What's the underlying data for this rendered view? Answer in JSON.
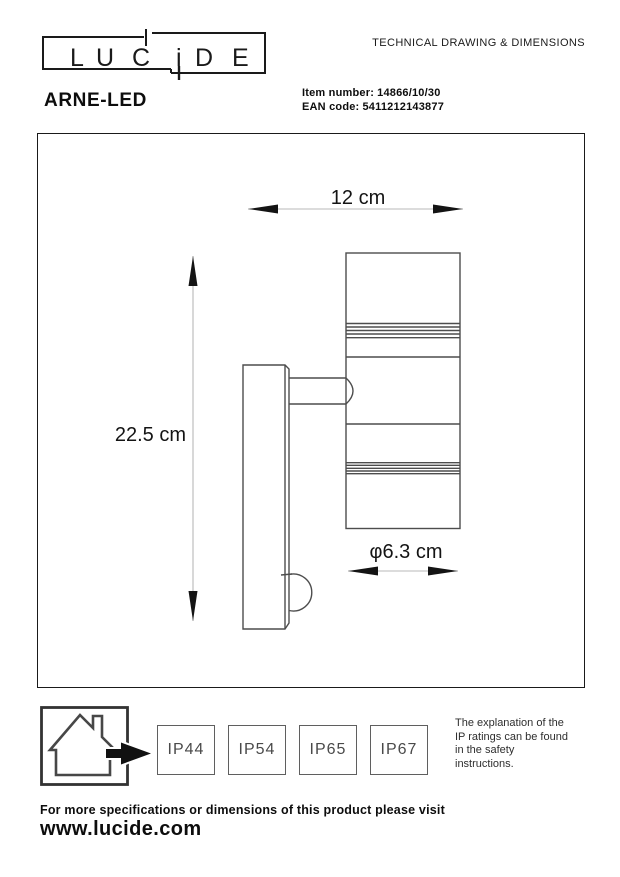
{
  "header": {
    "logo": {
      "text": "LUCIDE",
      "letters": [
        "L",
        "U",
        "C",
        "i",
        "D",
        "E"
      ]
    },
    "doc_title": "TECHNICAL DRAWING & DIMENSIONS",
    "product_name": "ARNE-LED",
    "item": {
      "label": "Item number:",
      "value": "14866/10/30"
    },
    "ean": {
      "label": "EAN code:",
      "value": "5411212143877"
    }
  },
  "drawing": {
    "dim_width": "12 cm",
    "dim_height": "22.5 cm",
    "dim_diameter": "φ6.3 cm"
  },
  "footer": {
    "ip_ratings": [
      "IP44",
      "IP54",
      "IP65",
      "IP67"
    ],
    "ip_note": "The explanation of the\nIP ratings can be found\nin the safety\ninstructions.",
    "more_info": "For more specifications or dimensions of this product please visit",
    "website": "www.lucide.com"
  },
  "colors": {
    "outline": "#4d4d4d",
    "dimension_line": "#b8b8b8",
    "text": "#111111",
    "ip_text": "#4a4a4a"
  }
}
